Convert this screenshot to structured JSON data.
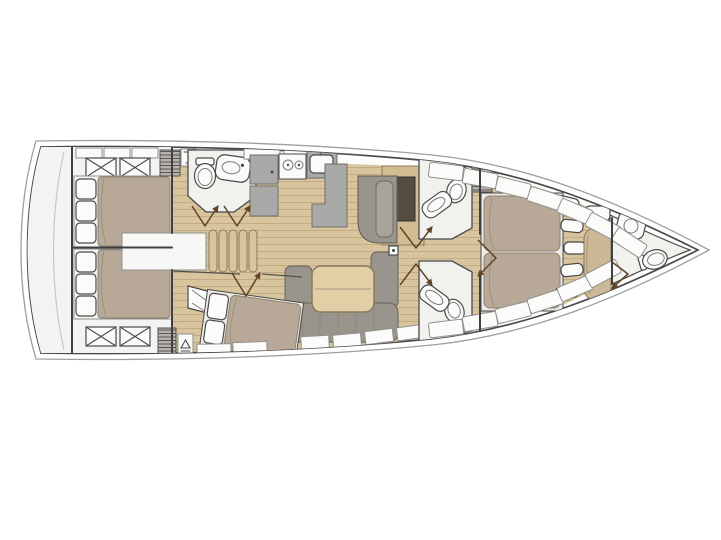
{
  "plan": {
    "type": "sailing-yacht-interior-floor-plan",
    "orientation": {
      "bow": "right",
      "stern": "left"
    },
    "rooms": [
      {
        "id": "transom",
        "name": "stern-transom",
        "fixtures": []
      },
      {
        "id": "aft-cabin-port",
        "name": "aft-cabin-double-berth-port",
        "fixtures": [
          "double-bed",
          "pillows",
          "deck-hatch",
          "deck-hatch"
        ]
      },
      {
        "id": "aft-cabin-starboard",
        "name": "aft-cabin-double-berth-starboard",
        "fixtures": [
          "double-bed",
          "pillows",
          "deck-hatch",
          "deck-hatch"
        ]
      },
      {
        "id": "aft-head",
        "name": "aft-bathroom",
        "fixtures": [
          "toilet",
          "sink"
        ]
      },
      {
        "id": "companionway",
        "name": "companionway-ladder",
        "fixtures": [
          "ladder-steps",
          "landing"
        ]
      },
      {
        "id": "galley",
        "name": "galley",
        "fixtures": [
          "refrigerator",
          "two-burner-stove",
          "sink",
          "counter",
          "peninsula-counter"
        ]
      },
      {
        "id": "nav-station",
        "name": "navigation-station",
        "fixtures": [
          "settee",
          "chart-table"
        ]
      },
      {
        "id": "salon",
        "name": "salon",
        "fixtures": [
          "u-shaped-sofa",
          "dining-table"
        ]
      },
      {
        "id": "mid-cabin",
        "name": "mid-cabin-berth",
        "fixtures": [
          "bed",
          "pillows",
          "wardrobe"
        ]
      },
      {
        "id": "fwd-head-port",
        "name": "forward-bathroom-port",
        "fixtures": [
          "toilet",
          "sink",
          "vent-locker"
        ]
      },
      {
        "id": "fwd-head-starboard",
        "name": "forward-bathroom-starboard",
        "fixtures": [
          "toilet",
          "sink",
          "vent-locker"
        ]
      },
      {
        "id": "master-cabin",
        "name": "forward-master-cabin",
        "fixtures": [
          "island-double-bed",
          "seat-cushions",
          "bench-seat",
          "pillow"
        ]
      },
      {
        "id": "bow-head",
        "name": "bow-ensuite-bathroom",
        "fixtures": [
          "toilet",
          "shower-sink"
        ]
      }
    ],
    "fixture_counts": {
      "toilets": 4,
      "sinks": 5,
      "berths": 4,
      "stove_burners": 2,
      "deck_hatches": 4
    }
  },
  "colors": {
    "background": "#ffffff",
    "hull_outline": "#4a4a4a",
    "hull_outer_line": "#9e9e9c",
    "deck_white": "#f3f3f1",
    "room_white": "#f1f1ee",
    "landing_white": "#f7f7f5",
    "wood_floor": "#d8c59e",
    "wood_plank_line": "#c3ac83",
    "wood_furniture": "#d2bd92",
    "wood_table": "#e1cfa6",
    "wood_edge": "#8a7a5c",
    "ladder_step": "#d9c59c",
    "mattress": "#b7a897",
    "mattress_edge": "#8f8274",
    "bedding_white": "#f6f5f2",
    "bed_frame": "#eeebe5",
    "sofa_gray": "#99958c",
    "sofa_gray_light": "#a8a49b",
    "counter_gray": "#a9a9a7",
    "appliance_white": "#fafaf9",
    "nav_table_brown": "#564c41",
    "bench_tan": "#cbb896",
    "hatch_box": "#b5b3ae",
    "hatch_stripe": "#5a5751",
    "door_swing": "#5f4426",
    "wall_line": "#3f3f3f"
  }
}
